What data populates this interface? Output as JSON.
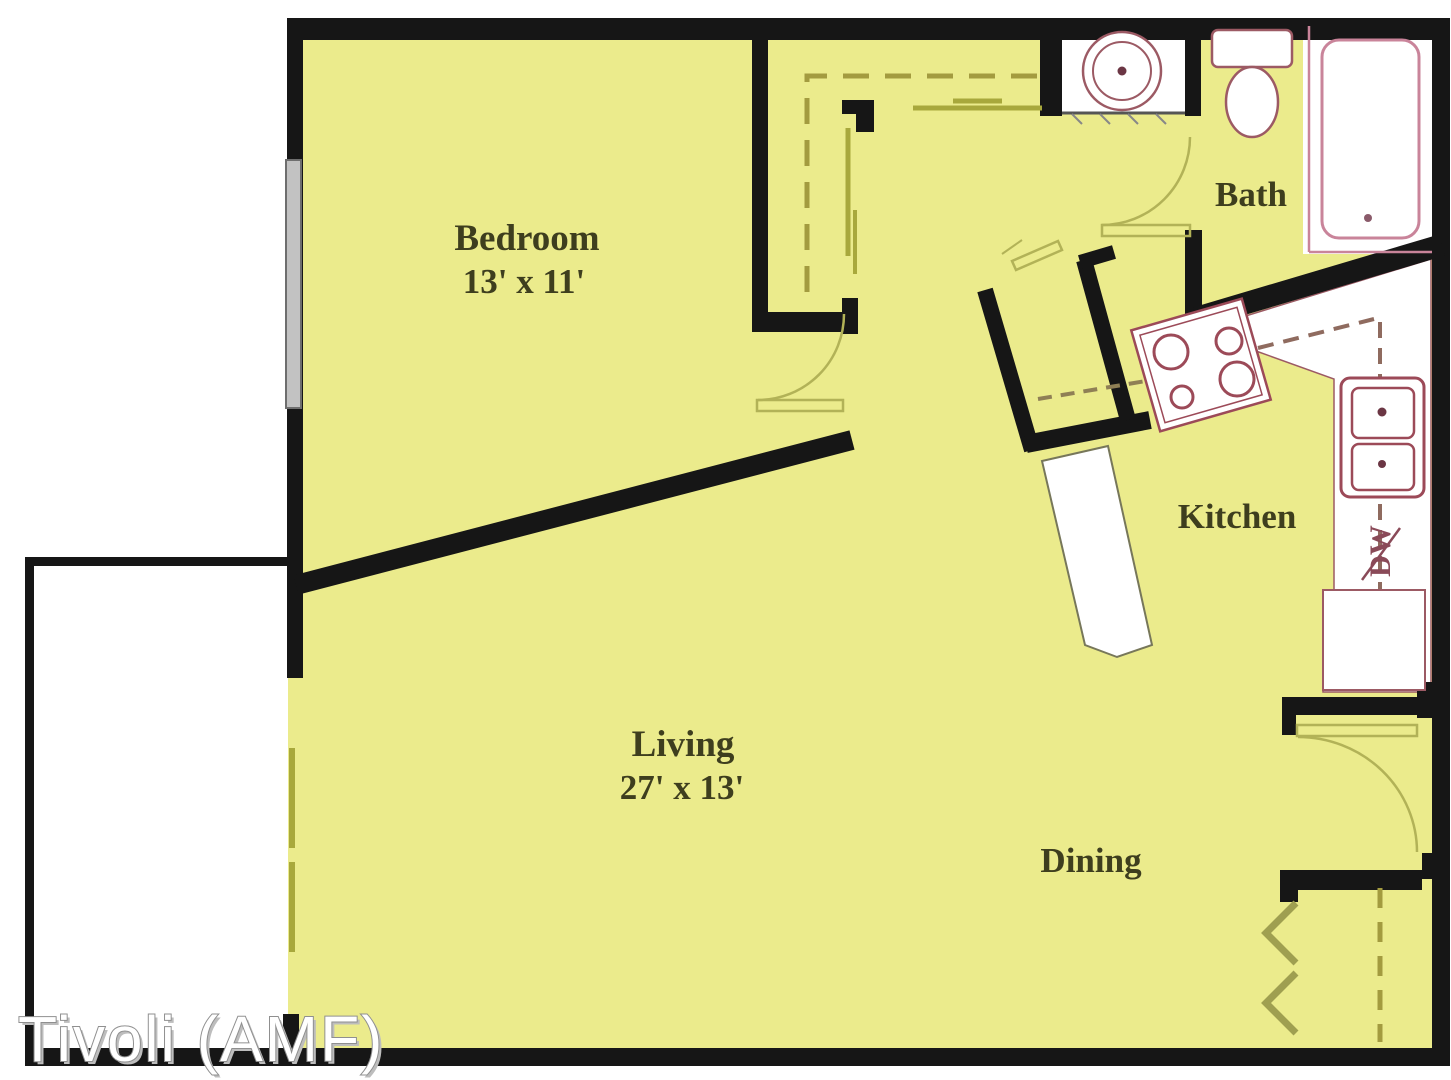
{
  "watermark": "Tivoli (AMF)",
  "rooms": {
    "bedroom": {
      "name": "Bedroom",
      "dims": "13' x 11'"
    },
    "living": {
      "name": "Living",
      "dims": "27' x 13'"
    },
    "bath": {
      "name": "Bath"
    },
    "kitchen": {
      "name": "Kitchen"
    },
    "dining": {
      "name": "Dining"
    }
  },
  "appliances": {
    "dishwasher": "DW"
  },
  "colors": {
    "floor_fill": "#ebeb8c",
    "wall": "#161616",
    "fixture_outline": "#9c5a64",
    "tub_outline": "#c9849a",
    "accent_olive": "#a8a83c",
    "dash_olive": "#a39b3f",
    "dash_kitchen": "#8f6b5f",
    "window_gray": "#b5b5b5",
    "label_color": "#3e3e1e",
    "watermark_fill": "#ffffff",
    "watermark_outline": "#8f8f8f"
  }
}
